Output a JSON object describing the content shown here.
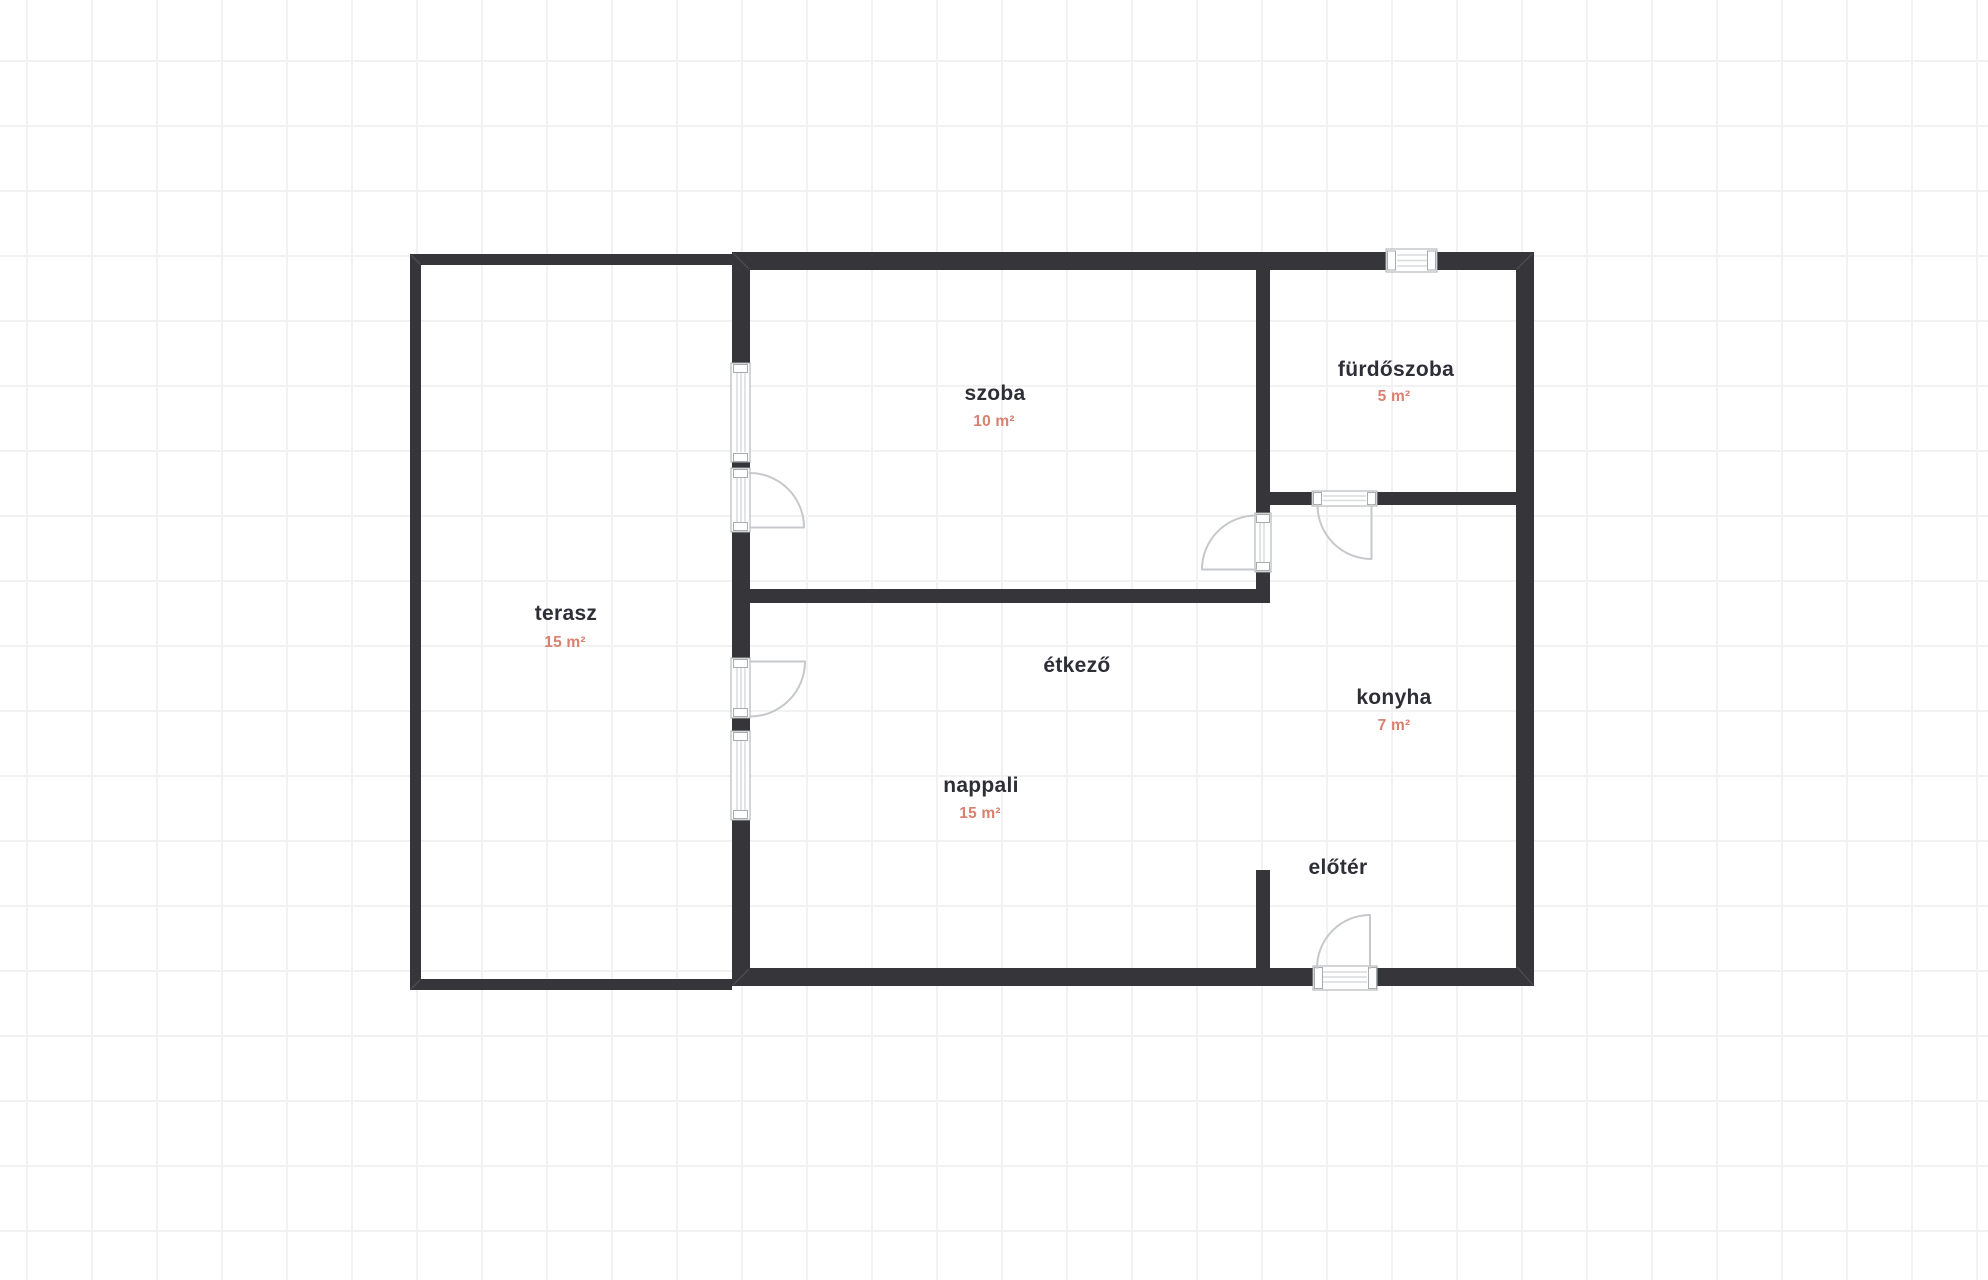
{
  "floor_plan": {
    "rooms": [
      {
        "name": "terasz",
        "area": "15 m²"
      },
      {
        "name": "szoba",
        "area": "10 m²"
      },
      {
        "name": "fürdőszoba",
        "area": "5 m²"
      },
      {
        "name": "étkező"
      },
      {
        "name": "konyha",
        "area": "7 m²"
      },
      {
        "name": "nappali",
        "area": "15 m²"
      },
      {
        "name": "előtér"
      }
    ],
    "colors": {
      "wall": "#35353a",
      "room_name_text": "#2e2e36",
      "area_text": "#d9806e",
      "door_swing": "#c6c8cb",
      "symbol_frame": "#a7abaf",
      "symbol_pane": "#d8dadc",
      "grid_line": "#f3f2f2",
      "background": "#ffffff"
    }
  }
}
